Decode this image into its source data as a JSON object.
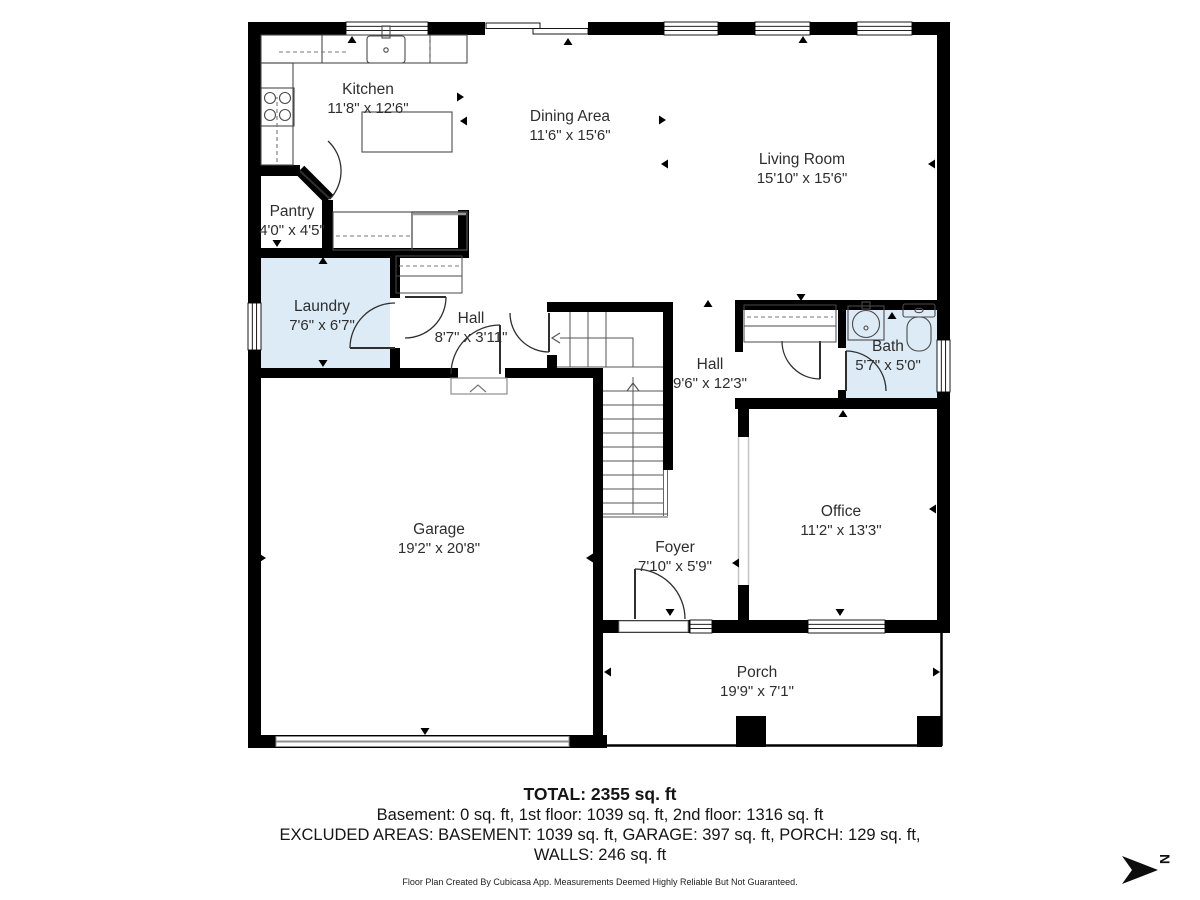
{
  "rooms": {
    "kitchen": {
      "name": "Kitchen",
      "dims": "11'8\" x 12'6\""
    },
    "dining": {
      "name": "Dining Area",
      "dims": "11'6\" x 15'6\""
    },
    "living": {
      "name": "Living Room",
      "dims": "15'10\" x 15'6\""
    },
    "pantry": {
      "name": "Pantry",
      "dims": "4'0\" x 4'5\""
    },
    "laundry": {
      "name": "Laundry",
      "dims": "7'6\" x 6'7\""
    },
    "hall_small": {
      "name": "Hall",
      "dims": "8'7\" x 3'11\""
    },
    "hall_large": {
      "name": "Hall",
      "dims": "9'6\" x 12'3\""
    },
    "bath": {
      "name": "Bath",
      "dims": "5'7\" x 5'0\""
    },
    "garage": {
      "name": "Garage",
      "dims": "19'2\" x 20'8\""
    },
    "office": {
      "name": "Office",
      "dims": "11'2\" x 13'3\""
    },
    "foyer": {
      "name": "Foyer",
      "dims": "7'10\" x 5'9\""
    },
    "porch": {
      "name": "Porch",
      "dims": "19'9\" x 7'1\""
    }
  },
  "summary": {
    "total": "TOTAL: 2355 sq. ft",
    "floors": "Basement: 0 sq. ft, 1st floor: 1039 sq. ft, 2nd floor: 1316 sq. ft",
    "excluded": "EXCLUDED AREAS: BASEMENT: 1039 sq. ft, GARAGE: 397 sq. ft, PORCH: 129 sq. ft,",
    "walls": "WALLS: 246 sq. ft",
    "disclaimer": "Floor Plan Created By Cubicasa App. Measurements Deemed Highly Reliable But Not Guaranteed."
  },
  "compass": {
    "label": "N"
  },
  "colors": {
    "wall": "#000000",
    "wet_room_fill": "#dcebf6",
    "fixture_line": "#4a4a4a"
  }
}
